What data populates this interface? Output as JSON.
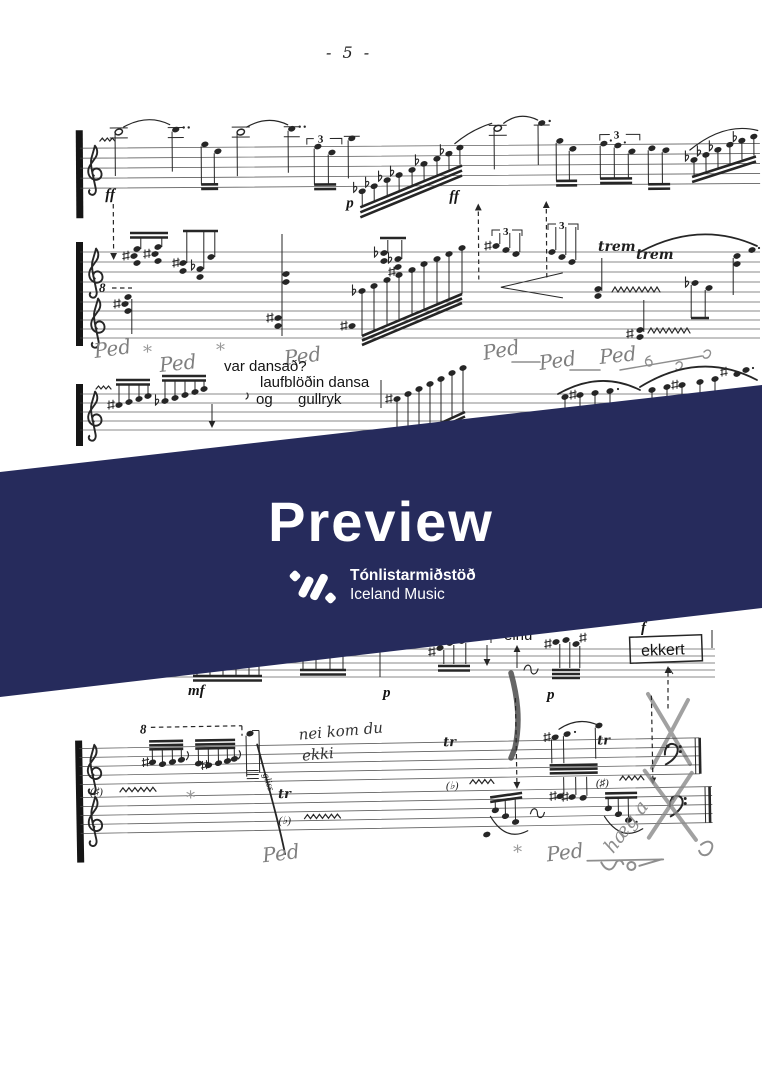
{
  "page": {
    "number": "- 5 -"
  },
  "banner": {
    "title": "Preview",
    "org_name": "Tónlistarmiðstöð",
    "org_subtitle": "Iceland Music",
    "background_color": "#262b5c",
    "text_color": "#ffffff"
  },
  "score": {
    "text": {
      "var_dansad": "var dansað?",
      "laufblodin": "laufblöðin dansa",
      "og": "og",
      "gullryk": "gullryk",
      "alt": "alt",
      "einu": "einu",
      "ekkert": "ekkert"
    },
    "dynamics": {
      "ff1": "ff",
      "p1": "p",
      "ff2": "ff",
      "mf1": "mf",
      "p2": "p",
      "p3": "p",
      "f1": "f"
    },
    "tuplets": {
      "t1": "3",
      "t2": "3",
      "t3": "3",
      "t4": "3"
    },
    "ottava": {
      "o1": "8",
      "o2": "8"
    },
    "tremolo": {
      "trem1": "trem",
      "trem2": "trem"
    },
    "trills": {
      "tr1": "tr",
      "tr2": "tr",
      "tr3": "tr",
      "gliss": "gliss"
    },
    "accidentals": {
      "a1": "(♯)",
      "a2": "(♭)",
      "a3": "(♭)",
      "a4": "(♯)"
    },
    "handwritten": {
      "ped1": "Ped",
      "ped2": "Ped",
      "ped3": "Ped",
      "ped4": "Ped",
      "ped5": "Ped",
      "ped6": "Ped",
      "ped7": "Ped",
      "ped8": "Ped",
      "star1": "*",
      "star2": "*",
      "star3": "*",
      "star4": "*",
      "nei_line1": "nei kom du",
      "nei_line2": "ekki",
      "haeg": "hæg a"
    }
  }
}
